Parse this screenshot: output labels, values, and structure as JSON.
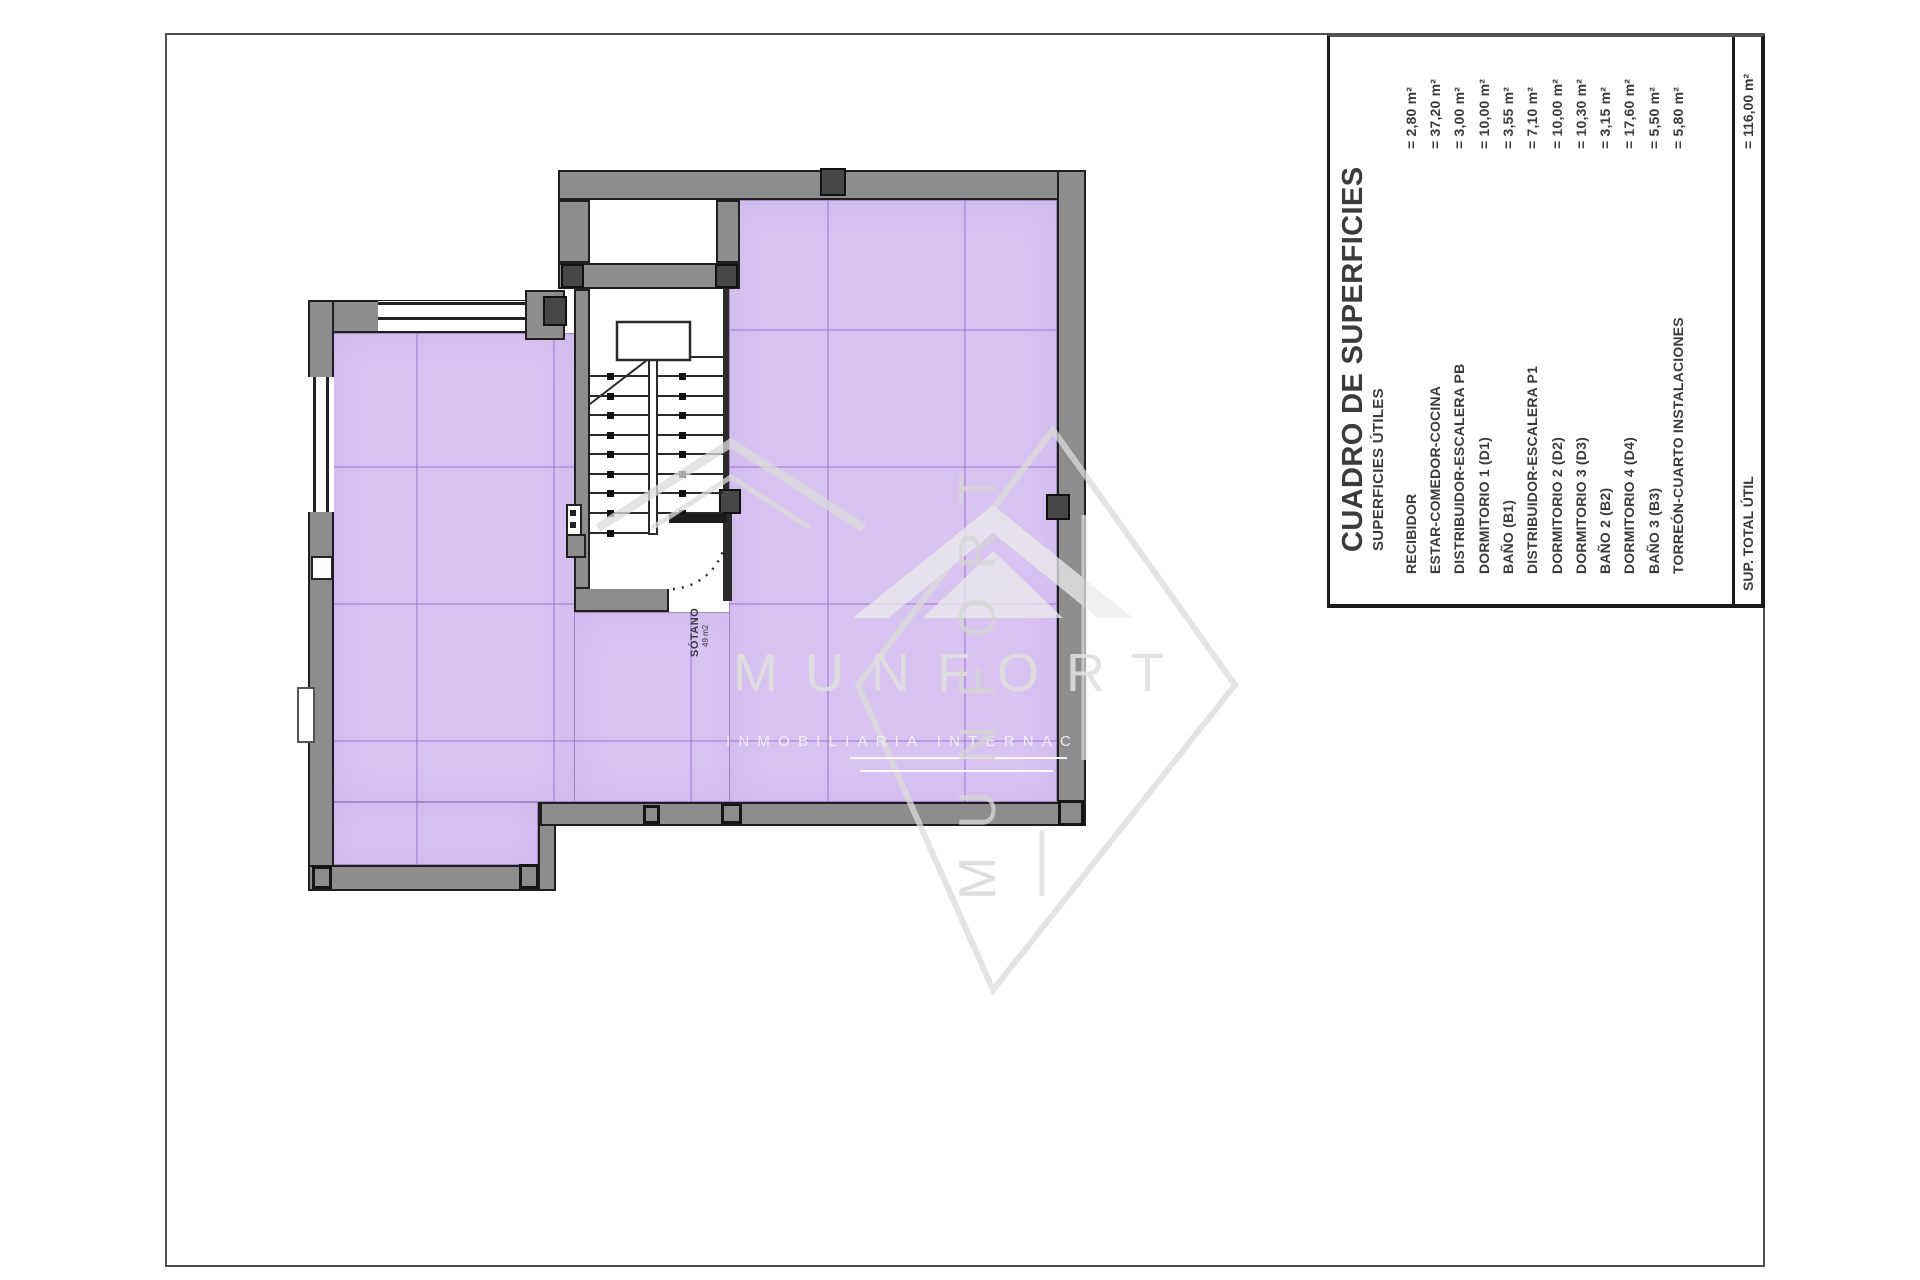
{
  "table": {
    "title": "CUADRO DE SUPERFICIES",
    "subtitle": "SUPERFICIES ÚTILES",
    "rows": [
      {
        "label": "RECIBIDOR",
        "value": "= 2,80 m²"
      },
      {
        "label": "ESTAR-COMEDOR-COCINA",
        "value": "= 37,20 m²"
      },
      {
        "label": "DISTRIBUIDOR-ESCALERA PB",
        "value": "= 3,00 m²"
      },
      {
        "label": "DORMITORIO 1 (D1)",
        "value": "= 10,00 m²"
      },
      {
        "label": "BAÑO (B1)",
        "value": "= 3,55 m²"
      },
      {
        "label": "DISTRIBUIDOR-ESCALERA P1",
        "value": "= 7,10 m²"
      },
      {
        "label": "DORMITORIO 2 (D2)",
        "value": "= 10,00 m²"
      },
      {
        "label": "DORMITORIO 3 (D3)",
        "value": "= 10,30 m²"
      },
      {
        "label": "BAÑO 2 (B2)",
        "value": "= 3,15 m²"
      },
      {
        "label": "DORMITORIO 4 (D4)",
        "value": "= 17,60 m²"
      },
      {
        "label": "BAÑO 3 (B3)",
        "value": "= 5,50 m²"
      },
      {
        "label": "TORREÓN-CUARTO INSTALACIONES",
        "value": "= 5,80 m²"
      }
    ],
    "total_label": "SUP. TOTAL ÚTIL",
    "total_value": "= 116,00 m²"
  },
  "plan": {
    "room_label": "SÓTANO",
    "room_area": "49 m2"
  },
  "watermark": {
    "brand": "MUNFORT",
    "tagline": "INMOBILIARIA INTERNAC"
  },
  "colors": {
    "floor_purple": "#d7c4f1",
    "wall_gray": "#8d8d8d",
    "grid_violet": "rgba(148,108,205,0.45)",
    "text_dark": "#3b3b3b"
  }
}
